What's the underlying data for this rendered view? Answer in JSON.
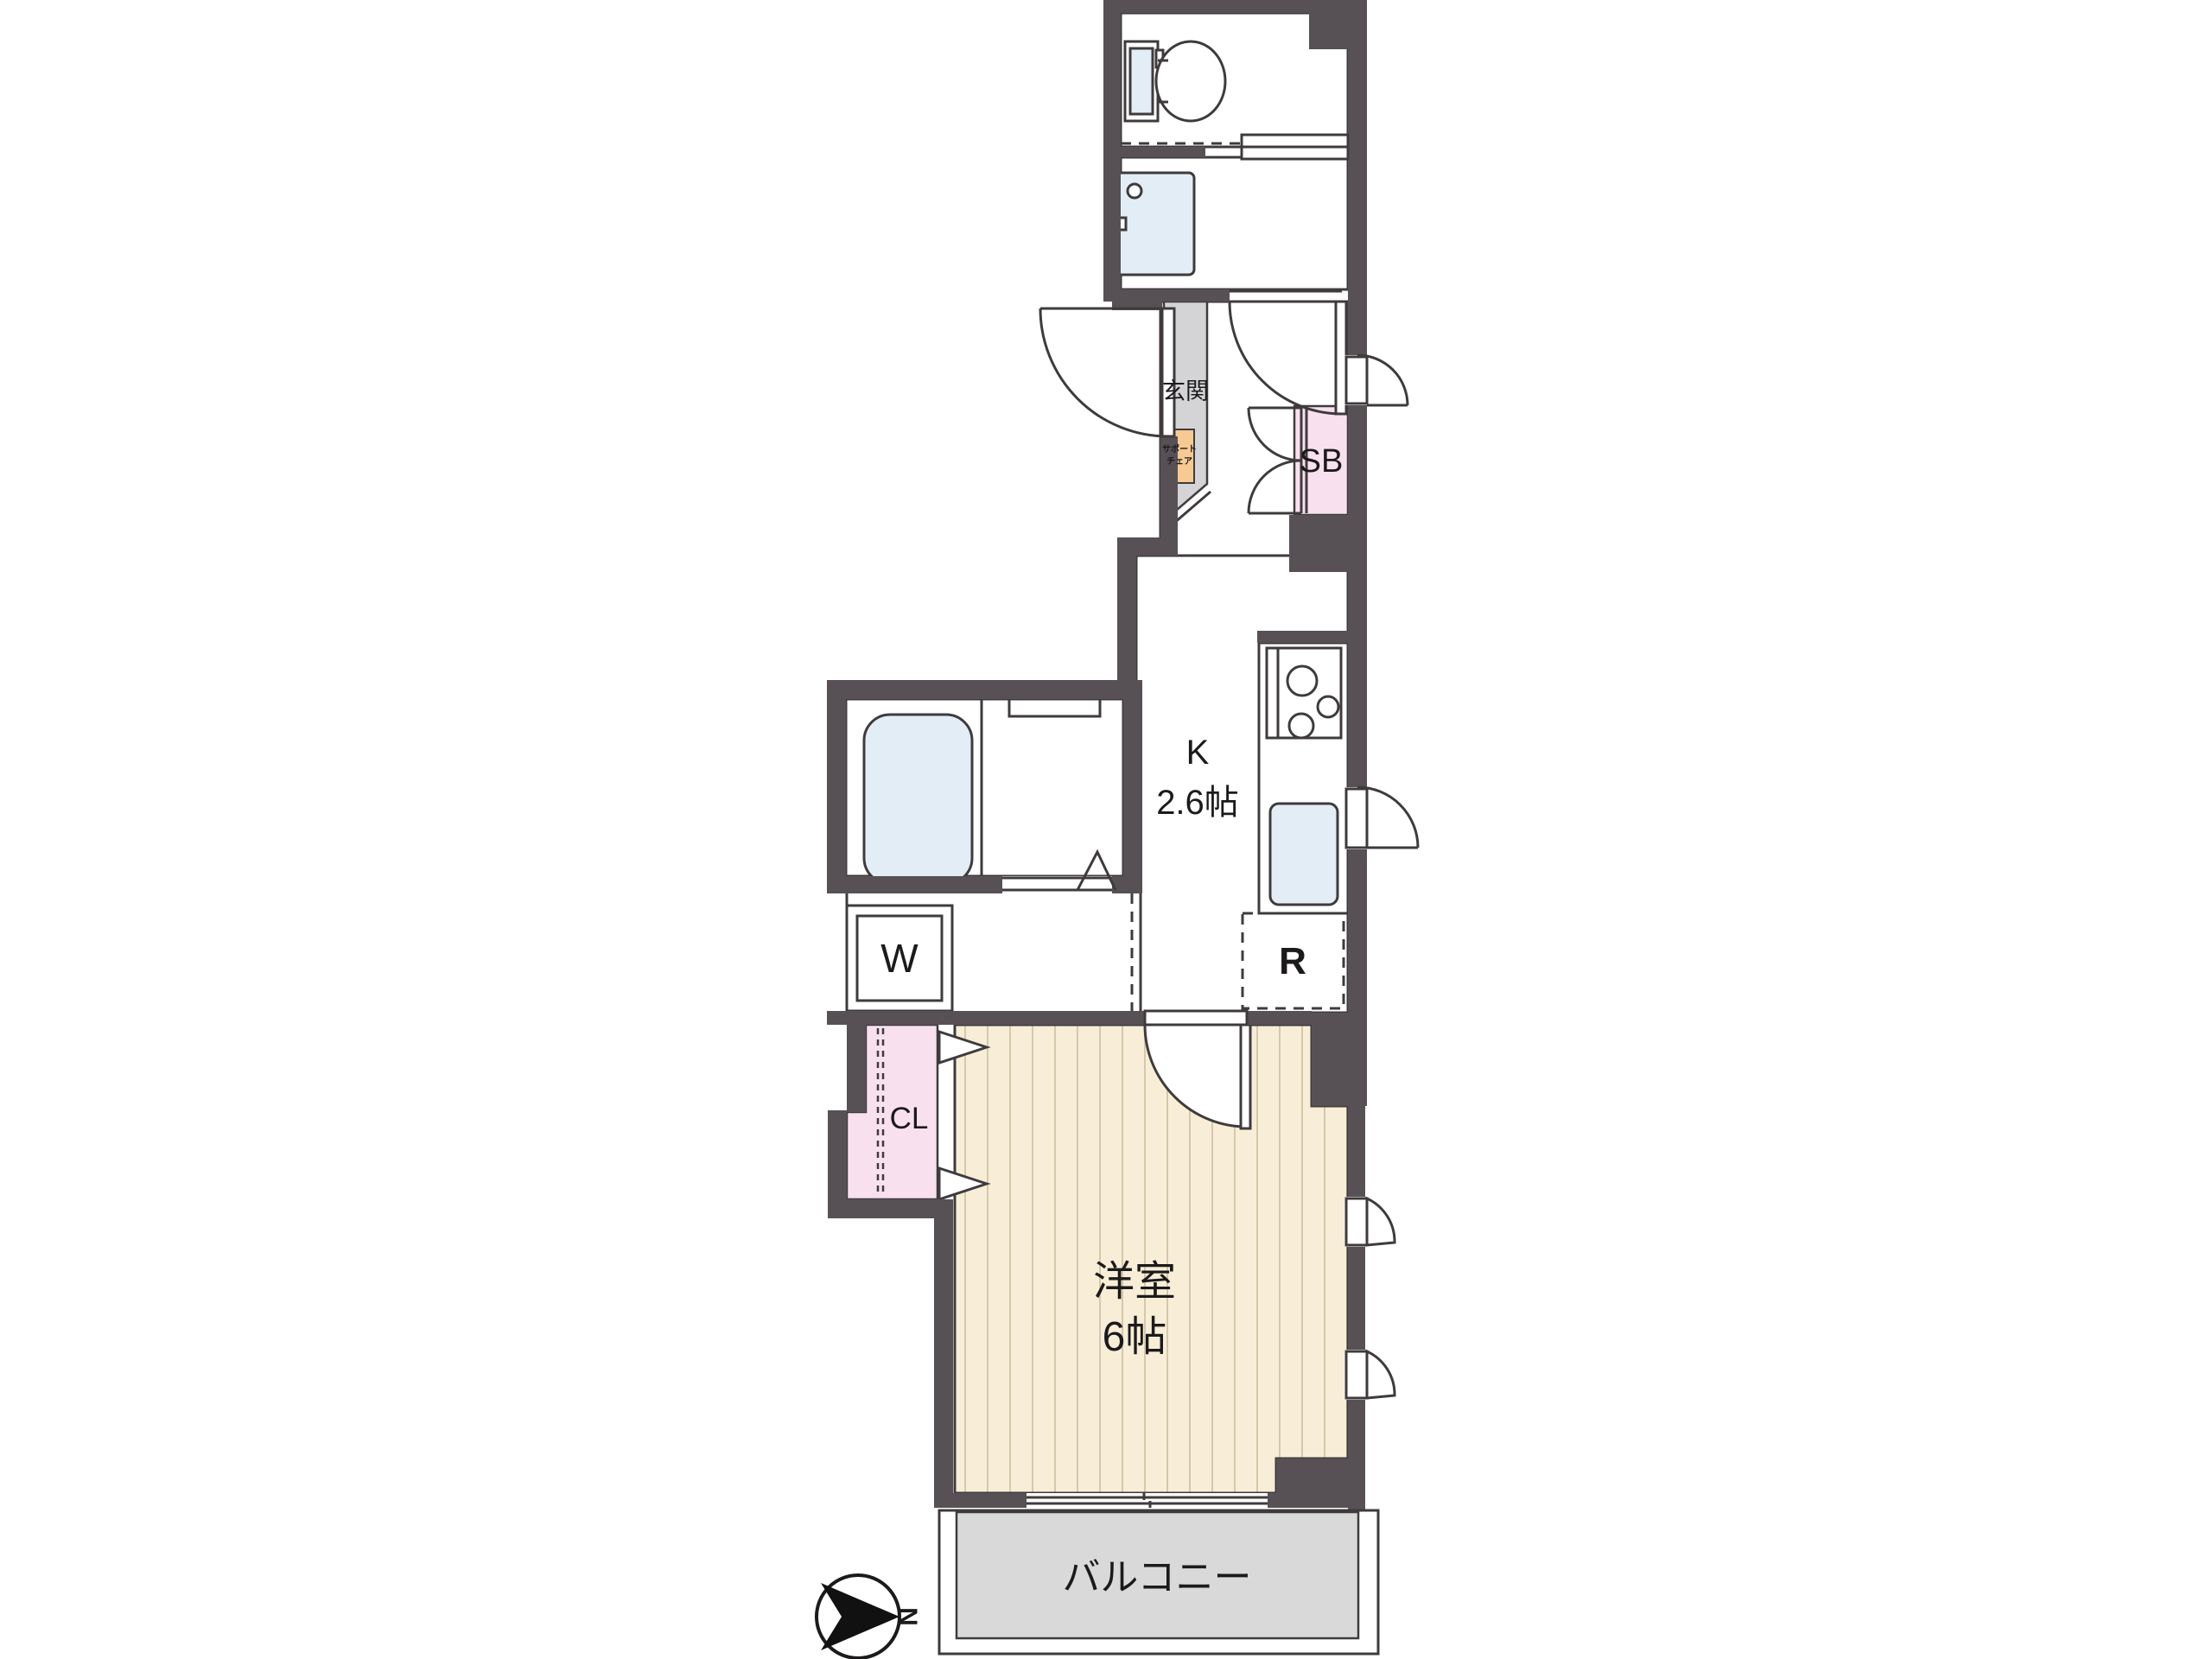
{
  "title": "1K apartment floor plan",
  "colors": {
    "wall": "#575156",
    "line": "#3f3b3d",
    "text": "#1c1a1b",
    "floor": "#f8eed7",
    "stripe": "#d5c8ab",
    "gray": "#d9d9d9",
    "genkan": "#d4d4d6",
    "pink": "#f8e0ef",
    "orange": "#f6ca92",
    "fixture": "#e3edf6"
  },
  "labels": {
    "genkan": "玄関",
    "support_chair": [
      "サポート",
      "チェア"
    ],
    "shoe_box": "SB",
    "kitchen": [
      "K",
      "2.6帖"
    ],
    "washer": "W",
    "refrigerator": "R",
    "closet": "CL",
    "western_room": [
      "洋室",
      "6帖"
    ],
    "balcony": "バルコニー",
    "compass_north": "N"
  }
}
